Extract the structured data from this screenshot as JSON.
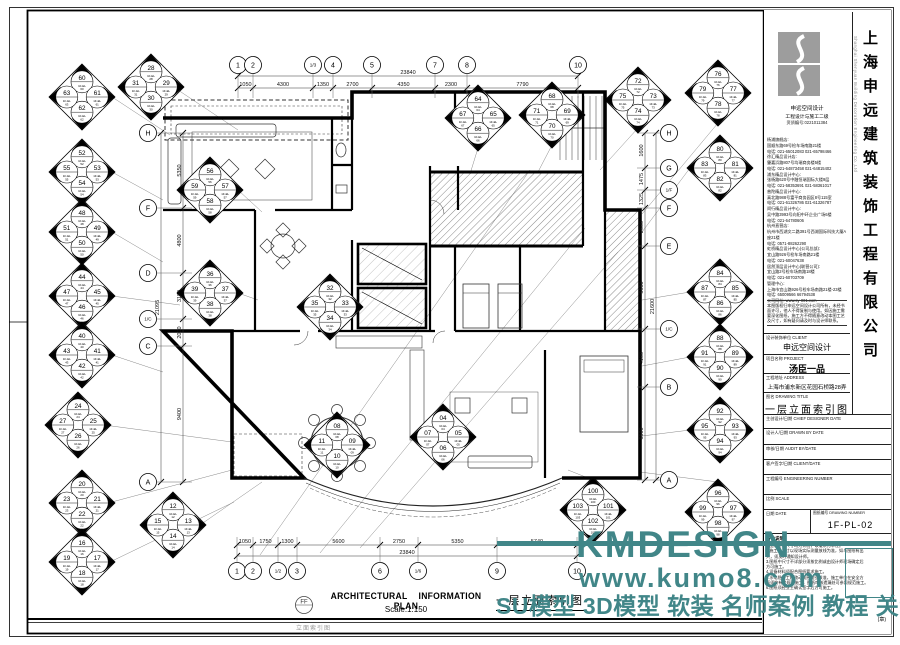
{
  "sheet": {
    "company_cn": "上海申远建筑装饰工程有限公司",
    "company_en": "Shanghai Shenyuan Building Decoration Engineering Co.,Ltd",
    "brand": "申远空间设计",
    "cert1": "工程设计与施工二级",
    "cert2": "资质编号:0221011384",
    "contacts": [
      "杨浦旗舰店:",
      "国顺东路69号检车场南路21楼",
      "电话: 021-65012083 021-65798466",
      "徐汇精品设计店:",
      "肇嘉浜路807号均瑞商务楼5楼",
      "电话: 021-64873458 021-64815402",
      "浦东精品设计中心:",
      "张杨路620号中融恒瑞国际大楼9层",
      "电话: 021-58353691 021-58361017",
      "普陀精品设计中心:",
      "真北路988号富平商务园区8号115室",
      "电话: 021-61326786 021-61326787",
      "闵行精品设计中心:",
      "吴中路3993号向阳中环企业广场6楼",
      "电话: 021-64780606",
      "杭州直营店:",
      "杭州市西湖文二路391号西湖国际科技大厦A座21楼",
      "电话: 0571-88262290",
      "虹桥精品设计中心(公司总部):",
      "宜山路926号检车场南路21楼",
      "电话: 021-60047638",
      "居然顶层设计中心(联营公司):",
      "宜山路2号检车场南路18楼",
      "电话: 021-60703709",
      "管理中心:",
      "上海市宜山路926号检车场南路21楼-23楼",
      "电话: 65009566 66794538",
      "公司网址: www.sy-001.com"
    ],
    "disclaimer": "本图版权归申远空间设计公司所有，未经书面许可，他人不得复制与使用。如因施工需要深化图纸，施工方不得随意改动本图工艺及尺寸，如有疑问请及时与设计师联系。",
    "client_label": "设计装饰单位 CLIENT",
    "client_value": "申远空间设计",
    "project_label": "项目名称 PROJECT",
    "project_value": "汤臣一品",
    "address_label": "工程地址 ADDRESS",
    "address_value": "上海市浦东新区花园石桥路28弄",
    "title_label": "图名 DRAWING TITLE",
    "title_value": "一层立面索引图",
    "chief_label": "主创设计/日期 CHIEF DESIGNER DATE",
    "drawn_label": "设计人/日期 DRAWN BY DATE",
    "audit_label": "审核/日期 AUDIT BY/DATE",
    "sign_label": "客户签字/日期 CLIENT/DATE",
    "engno_label": "工程编号 ENGINEERING NUMBER",
    "scale_label": "比例 SCALE",
    "date_label": "日期 DATE",
    "dwgno_label": "图纸编号 DRAWING NUMBER",
    "dwgno_value": "1F-PL-02",
    "notes_title": "备注说明:",
    "notes": [
      "1.图纸所标尺寸均为公制，以毫米为单位。",
      "2.施工时尺寸以现场实际测量放线为准，如与图纸有出",
      "  入，须及时通知设计师。",
      "3.图纸中尺寸不详部分须按比例或由设计师现场确定后",
      "  方可施工。",
      "4.设备材料须配合图纸要求施工。",
      "5.水电隐蔽工程改动须经物业核准，施工单位在安全方",
      "  面须按有关规范施工，图纸审核遗漏处可参照规范施工。",
      "6.图纸须经业主确认签字后方可施工。"
    ],
    "seal_note": "(章)"
  },
  "footer": {
    "title_en": "ARCHITECTURAL INFORMATION PLAN",
    "scale": "Scale:1:150",
    "title_cn": "一层立面索引图",
    "circle_label": "FF",
    "margin_note": "立面索引图"
  },
  "watermark": {
    "brand": "KMDESIGN",
    "url": "www.kumo8.com",
    "slogan": "SU模型 3D模型 软装 名师案例 教程 关注酷模吧",
    "color": "#418688"
  },
  "diamond_ref": "1F-EL",
  "index_diamonds": [
    {
      "x": 82,
      "y": 97,
      "n": [
        "60",
        "61",
        "62",
        "63"
      ]
    },
    {
      "x": 151,
      "y": 87,
      "n": [
        "28",
        "29",
        "30",
        "31"
      ]
    },
    {
      "x": 82,
      "y": 172,
      "n": [
        "52",
        "53",
        "54",
        "55"
      ]
    },
    {
      "x": 210,
      "y": 190,
      "n": [
        "56",
        "57",
        "58",
        "59"
      ]
    },
    {
      "x": 82,
      "y": 232,
      "n": [
        "48",
        "49",
        "50",
        "51"
      ]
    },
    {
      "x": 82,
      "y": 296,
      "n": [
        "44",
        "45",
        "46",
        "47"
      ]
    },
    {
      "x": 210,
      "y": 293,
      "n": [
        "36",
        "37",
        "38",
        "39"
      ]
    },
    {
      "x": 82,
      "y": 355,
      "n": [
        "40",
        "41",
        "42",
        "43"
      ]
    },
    {
      "x": 78,
      "y": 425,
      "n": [
        "24",
        "25",
        "26",
        "27"
      ]
    },
    {
      "x": 82,
      "y": 503,
      "n": [
        "20",
        "21",
        "22",
        "23"
      ]
    },
    {
      "x": 82,
      "y": 562,
      "n": [
        "16",
        "17",
        "18",
        "19"
      ]
    },
    {
      "x": 173,
      "y": 525,
      "n": [
        "12",
        "13",
        "14",
        "15"
      ]
    },
    {
      "x": 478,
      "y": 118,
      "n": [
        "64",
        "65",
        "66",
        "67"
      ]
    },
    {
      "x": 552,
      "y": 115,
      "n": [
        "68",
        "69",
        "70",
        "71"
      ]
    },
    {
      "x": 638,
      "y": 100,
      "n": [
        "72",
        "73",
        "74",
        "75"
      ]
    },
    {
      "x": 718,
      "y": 93,
      "n": [
        "76",
        "77",
        "78",
        "79"
      ]
    },
    {
      "x": 720,
      "y": 168,
      "n": [
        "80",
        "81",
        "82",
        "83"
      ]
    },
    {
      "x": 720,
      "y": 292,
      "n": [
        "84",
        "85",
        "86",
        "87"
      ]
    },
    {
      "x": 720,
      "y": 357,
      "n": [
        "88",
        "89",
        "90",
        "91"
      ]
    },
    {
      "x": 720,
      "y": 430,
      "n": [
        "92",
        "93",
        "94",
        "95"
      ]
    },
    {
      "x": 718,
      "y": 512,
      "n": [
        "96",
        "97",
        "98",
        "99"
      ]
    },
    {
      "x": 593,
      "y": 510,
      "n": [
        "100",
        "101",
        "102",
        "103"
      ]
    },
    {
      "x": 330,
      "y": 307,
      "n": [
        "32",
        "33",
        "34",
        "35"
      ]
    },
    {
      "x": 443,
      "y": 437,
      "n": [
        "04",
        "05",
        "06",
        "07"
      ]
    },
    {
      "x": 337,
      "y": 445,
      "n": [
        "08",
        "09",
        "10",
        "11"
      ]
    }
  ],
  "grid_bubbles": {
    "top": {
      "y": 65,
      "items": [
        {
          "l": "1",
          "x": 238
        },
        {
          "l": "2",
          "x": 253
        },
        {
          "l": "1/3",
          "x": 313
        },
        {
          "l": "4",
          "x": 333
        },
        {
          "l": "5",
          "x": 372
        },
        {
          "l": "7",
          "x": 435
        },
        {
          "l": "8",
          "x": 467
        },
        {
          "l": "10",
          "x": 578
        }
      ]
    },
    "bottom": {
      "y": 571,
      "items": [
        {
          "l": "1",
          "x": 237
        },
        {
          "l": "2",
          "x": 253
        },
        {
          "l": "1/2",
          "x": 278
        },
        {
          "l": "3",
          "x": 297
        },
        {
          "l": "6",
          "x": 380
        },
        {
          "l": "1/6",
          "x": 418
        },
        {
          "l": "9",
          "x": 497
        },
        {
          "l": "10",
          "x": 577
        }
      ]
    },
    "left": {
      "x": 148,
      "items": [
        {
          "l": "H",
          "y": 133
        },
        {
          "l": "F",
          "y": 208
        },
        {
          "l": "D",
          "y": 273
        },
        {
          "l": "1/C",
          "y": 319
        },
        {
          "l": "C",
          "y": 346
        },
        {
          "l": "A",
          "y": 482
        }
      ]
    },
    "right": {
      "x": 669,
      "items": [
        {
          "l": "H",
          "y": 133
        },
        {
          "l": "G",
          "y": 168
        },
        {
          "l": "1/F",
          "y": 190
        },
        {
          "l": "F",
          "y": 208
        },
        {
          "l": "E",
          "y": 246
        },
        {
          "l": "1/C",
          "y": 329
        },
        {
          "l": "B",
          "y": 387
        },
        {
          "l": "A",
          "y": 480
        }
      ]
    }
  },
  "dimensions": {
    "top": {
      "orient": "h",
      "line": 88,
      "bounds": [
        238,
        253,
        313,
        333,
        372,
        435,
        467,
        578
      ],
      "labels": [
        "1050",
        "4300",
        "1350",
        "2700",
        "4350",
        "2300",
        "7790"
      ],
      "total_line": 76,
      "total": "23840"
    },
    "bottom": {
      "orient": "h",
      "line": 545,
      "bounds": [
        237,
        253,
        278,
        297,
        380,
        418,
        497,
        577
      ],
      "labels": [
        "1050",
        "1750",
        "1300",
        "5600",
        "2750",
        "5350",
        "5740"
      ],
      "total_line": 556,
      "total": "23840"
    },
    "left": {
      "orient": "v",
      "line": 183,
      "bounds": [
        133,
        208,
        273,
        319,
        346,
        482
      ],
      "labels": [
        "5350",
        "4800",
        "3150",
        "2000",
        "9400"
      ],
      "total_line": 161,
      "total": "21095"
    },
    "right": {
      "orient": "v",
      "line": 645,
      "bounds": [
        133,
        168,
        190,
        208,
        246,
        329,
        387,
        480
      ],
      "labels": [
        "1600",
        "1475",
        "1325",
        "2600",
        "5650",
        "4100",
        "6500"
      ],
      "total_line": 656,
      "total": "21600"
    }
  }
}
